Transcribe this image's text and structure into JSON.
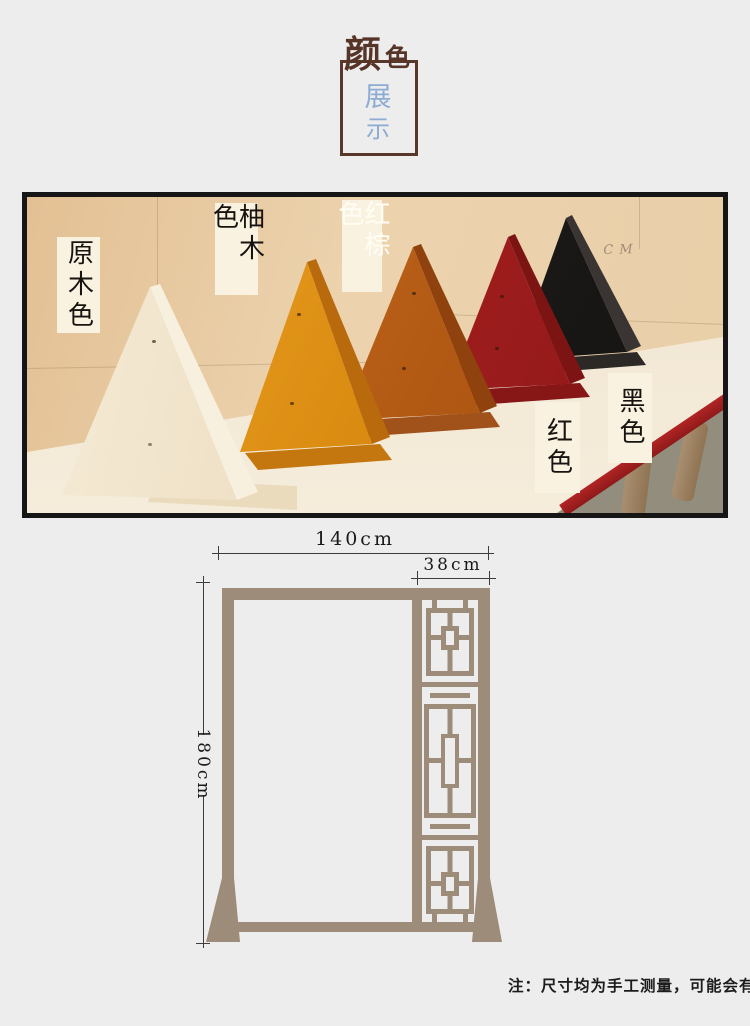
{
  "title": {
    "main_1": "颜",
    "main_2": "色",
    "sub_1": "展",
    "sub_2": "示"
  },
  "photo": {
    "wall_marking": "7 CM",
    "labels": {
      "natural": "原木色",
      "teak": "柚木色",
      "red_brown": "红棕色",
      "red": "红色",
      "black": "黑色"
    },
    "colors": {
      "natural": "#f0e2c8",
      "teak": "#d98a10",
      "red_brown": "#b35a14",
      "red": "#9c1c1c",
      "black": "#1b1917"
    }
  },
  "diagram": {
    "total_width": "140cm",
    "lattice_width": "38cm",
    "height": "180cm",
    "frame_color": "#9c8c79"
  },
  "footnote": {
    "text": "注：尺寸均为手工测量，可能会有误差"
  }
}
